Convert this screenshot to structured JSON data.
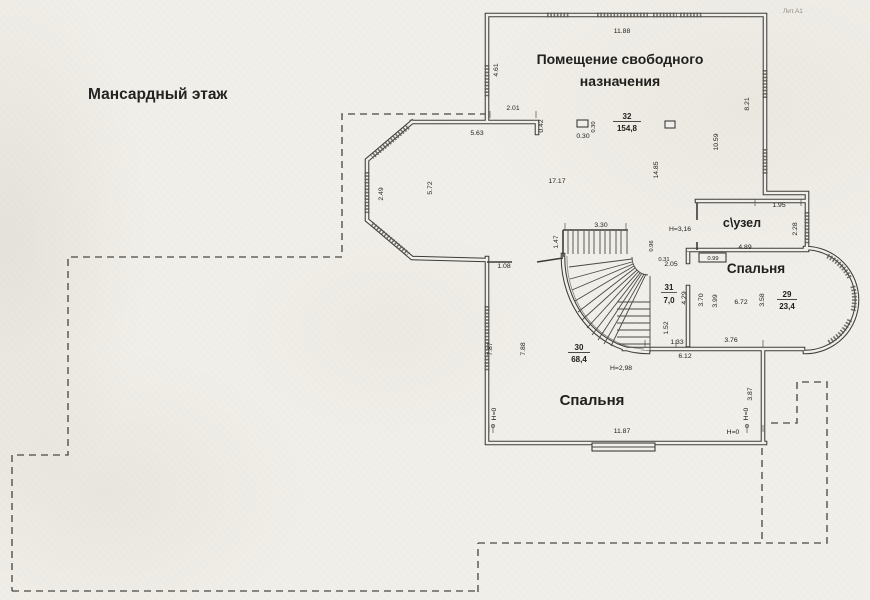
{
  "floor_title": "Мансардный этаж",
  "sheet_mark": "Лит.А1",
  "rooms": {
    "free_purpose": {
      "name_line1": "Помещение свободного",
      "name_line2": "назначения",
      "number": "32",
      "area": "154,8"
    },
    "wc": {
      "name": "с\\узел"
    },
    "bedroom29": {
      "name": "Спальня",
      "number": "29",
      "area": "23,4"
    },
    "bedroom30": {
      "name": "Спальня",
      "number": "30",
      "area": "68,4"
    },
    "stairs": {
      "number": "31",
      "area": "7,0"
    }
  },
  "dims": {
    "top_wall": "11.88",
    "left_wall_upper": "4.61",
    "passage": "2.01",
    "stub": "0.42",
    "hall_top": "5.63",
    "flue_w": "0.30",
    "flue_h": "0.30",
    "hall_length": "17.17",
    "bay_width": "5.72",
    "bay_window": "2.49",
    "interior_span": "14.85",
    "right_wall_upper": "8.21",
    "right_inner": "10.59",
    "stair_run": "3.30",
    "stair_width": "1.47",
    "stair_a": "0.96",
    "stair_b": "0.31",
    "stair_c": "2.05",
    "stair_d": "4.29",
    "stair_e": "1.52",
    "wc_top": "1.95",
    "wc_right": "2.28",
    "wc_width": "4.89",
    "br29_notch": "0.99",
    "br29_left_a": "3.70",
    "br29_left_b": "3.99",
    "br29_width": "6.72",
    "br29_right": "3.58",
    "br29_bottom": "3.76",
    "landing": "1.33",
    "landing_total": "6.12",
    "hall_stub": "1.08",
    "br30_left_out": "7.87",
    "br30_left_in": "7.88",
    "br30_bottom": "11.87",
    "br30_right": "3.87"
  },
  "marks": {
    "h_316": "Н=3,16",
    "h_298": "Н=2,98",
    "h_0": "Н=0"
  }
}
